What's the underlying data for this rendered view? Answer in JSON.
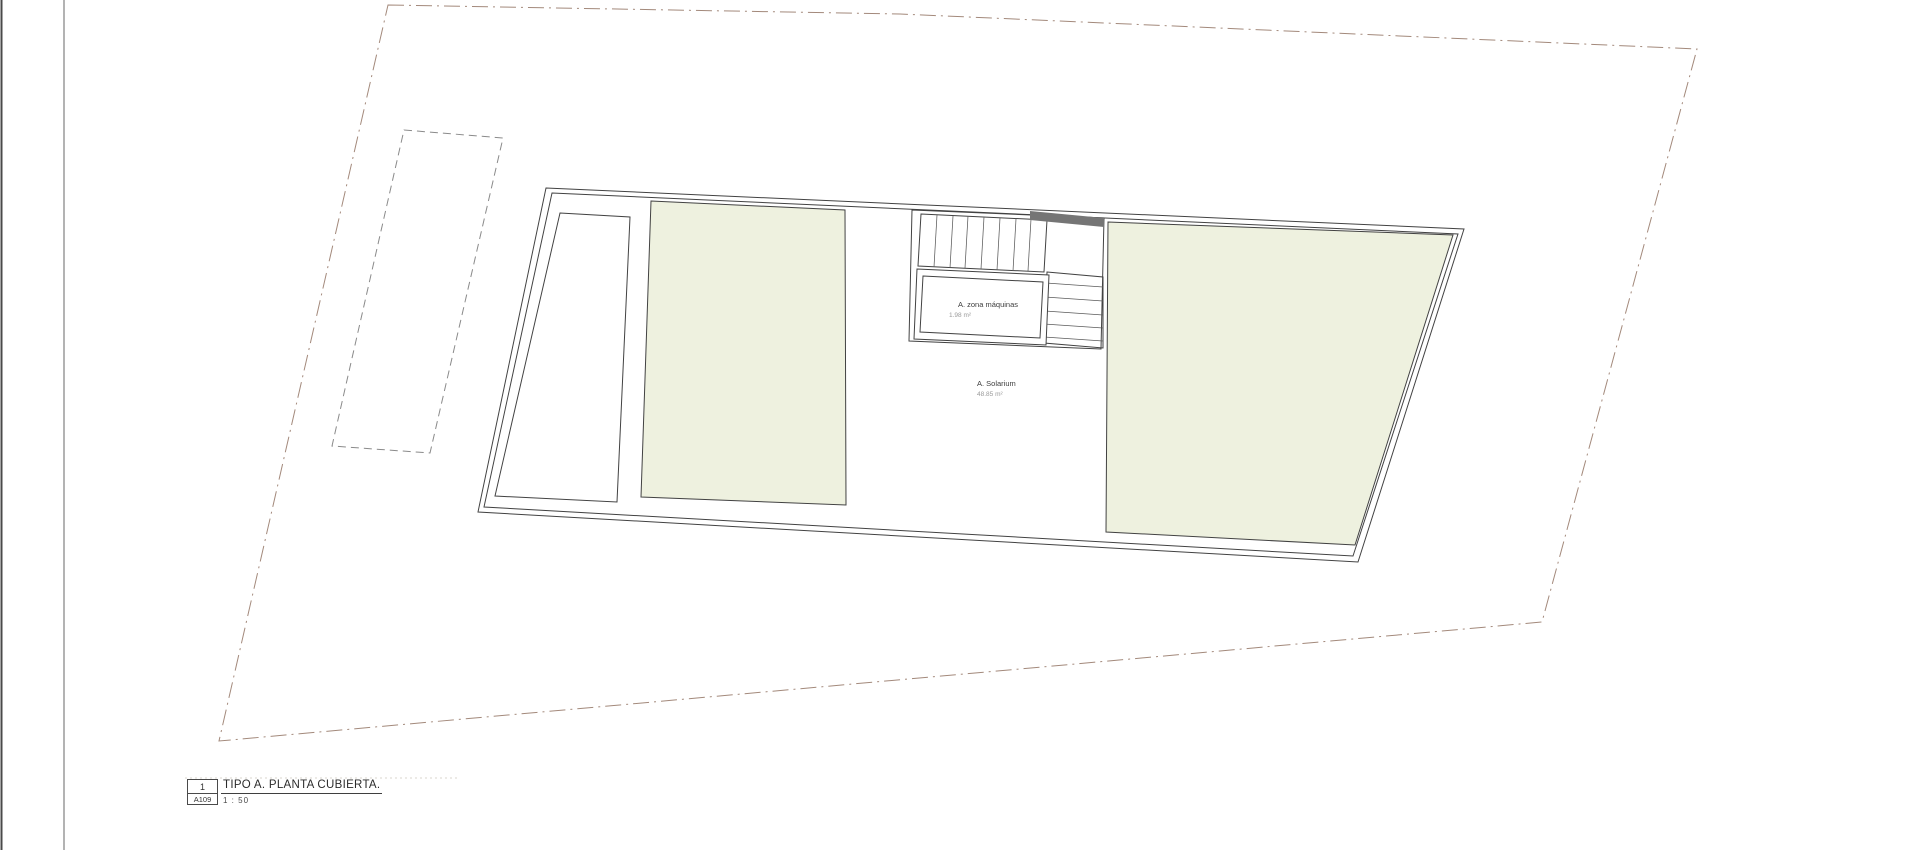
{
  "drawing": {
    "rooms": {
      "solarium": {
        "name": "A. Solarium",
        "area": "48.85 m²"
      },
      "machine_zone": {
        "name": "A. zona máquinas",
        "area": "1.98 m²"
      }
    },
    "title_block": {
      "detail_number": "1",
      "sheet_number": "A109",
      "title": "TIPO A. PLANTA CUBIERTA.",
      "scale": "1 : 50"
    },
    "colors": {
      "roof_green": "#eef1df",
      "stair_bar_gray": "#757575",
      "boundary_line": "#a3897b",
      "area_text_gray": "#9a9a9a"
    }
  }
}
